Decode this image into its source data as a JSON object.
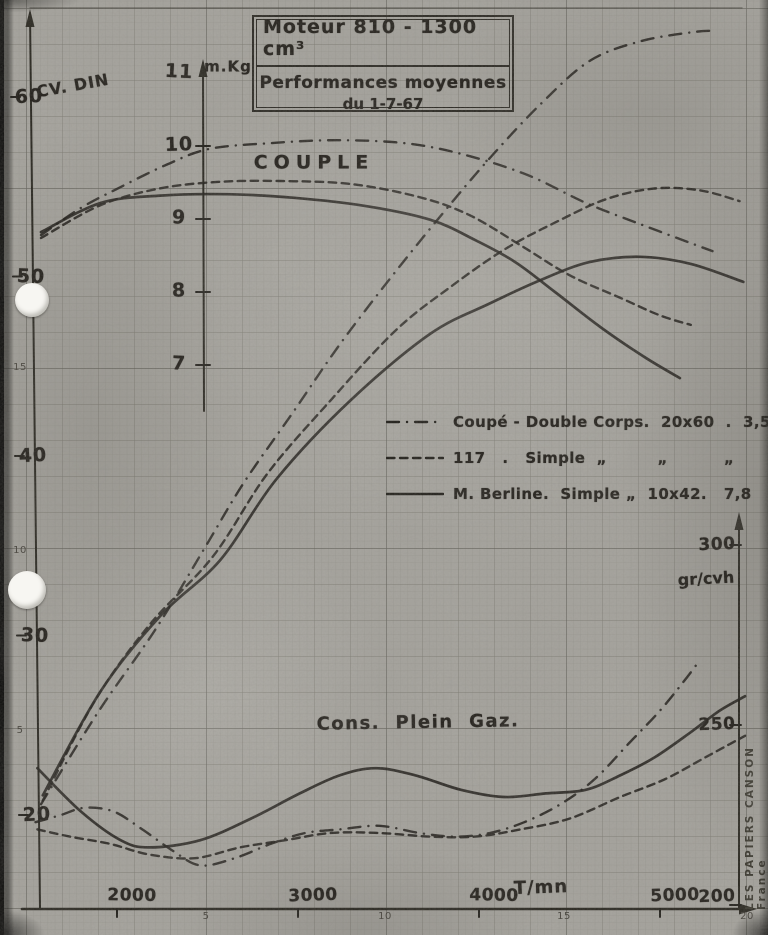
{
  "document": {
    "title_line1": "Moteur 810  - 1300 cm³",
    "title_line2": "Performances moyennes",
    "title_line3": "du 1-7-67",
    "brand_vertical_text": "LES PAPIERS CANSON  France"
  },
  "annotations": {
    "torque_label": "COUPLE",
    "consumption_label": "Cons.  Plein  Gaz.",
    "power_axis_title": "CV. DIN",
    "torque_axis_title": "m.Kg",
    "consumption_axis_title": "gr/cvh",
    "rpm_axis_title": "T/mn"
  },
  "legend": {
    "rows": [
      {
        "style": "dashdot",
        "label": "Coupé - Double Corps.  20x60  .  3,5"
      },
      {
        "style": "dashed",
        "label": "117   .   Simple  „         „          „"
      },
      {
        "style": "solid",
        "label": "M. Berline.  Simple „  10x42.   7,8"
      }
    ]
  },
  "colors": {
    "paper": "#a8a6a0",
    "ink": "#1f1d18",
    "grid": "#6e6c62"
  },
  "chart_data": {
    "type": "line",
    "title": "Moteur 810 - 1300 cm³ — Performances moyennes du 1-7-67",
    "grid": true,
    "legend_position": "middle-right",
    "x_axis": {
      "label": "T/mn",
      "ticks": [
        2000,
        3000,
        4000,
        5000
      ],
      "range": [
        1550,
        5550
      ]
    },
    "y_axes": {
      "power_cv_din": {
        "label": "CV. DIN",
        "ticks": [
          60,
          50,
          40,
          30,
          20
        ],
        "range": [
          15,
          65
        ]
      },
      "torque_mkg": {
        "label": "m.Kg",
        "ticks": [
          11,
          10,
          9,
          8,
          7
        ],
        "range": [
          6.5,
          11.5
        ]
      },
      "consumption_gr_cvh": {
        "label": "gr/cvh",
        "ticks": [
          300,
          250,
          200
        ],
        "range": [
          195,
          310
        ]
      }
    },
    "paper_scale_numbers": {
      "bottom": [
        "5",
        "10",
        "15",
        "20"
      ],
      "left": [
        "15",
        "10",
        "5"
      ]
    },
    "series": [
      {
        "id": "power-coupe",
        "name": "Coupé Double Corps — puissance (CV DIN)",
        "style": "dashdot",
        "unit": "cv",
        "points": [
          [
            1580,
            20.6
          ],
          [
            1900,
            25.8
          ],
          [
            2210,
            30.3
          ],
          [
            2480,
            34.8
          ],
          [
            2700,
            38.5
          ],
          [
            2970,
            42.4
          ],
          [
            3230,
            46.2
          ],
          [
            3510,
            49.9
          ],
          [
            3790,
            53.4
          ],
          [
            4060,
            56.6
          ],
          [
            4340,
            59.6
          ],
          [
            4610,
            62.0
          ],
          [
            4890,
            63.1
          ],
          [
            5170,
            63.6
          ],
          [
            5310,
            63.7
          ]
        ]
      },
      {
        "id": "power-117",
        "name": "117 Simple — puissance (CV DIN)",
        "style": "dashed",
        "unit": "cv",
        "points": [
          [
            1590,
            20.8
          ],
          [
            1880,
            26.4
          ],
          [
            2180,
            30.6
          ],
          [
            2530,
            34.4
          ],
          [
            2830,
            39.0
          ],
          [
            3180,
            43.1
          ],
          [
            3540,
            47.0
          ],
          [
            3840,
            49.4
          ],
          [
            4140,
            51.5
          ],
          [
            4420,
            53.0
          ],
          [
            4700,
            54.3
          ],
          [
            4970,
            54.9
          ],
          [
            5220,
            54.8
          ],
          [
            5440,
            54.2
          ]
        ]
      },
      {
        "id": "power-berline",
        "name": "M. Berline Simple — puissance (CV DIN)",
        "style": "solid",
        "unit": "cv",
        "points": [
          [
            1590,
            21.1
          ],
          [
            1910,
            26.9
          ],
          [
            2240,
            31.1
          ],
          [
            2570,
            34.2
          ],
          [
            2880,
            38.7
          ],
          [
            3290,
            43.1
          ],
          [
            3730,
            46.8
          ],
          [
            4060,
            48.5
          ],
          [
            4340,
            49.8
          ],
          [
            4610,
            50.8
          ],
          [
            4890,
            51.1
          ],
          [
            5170,
            50.7
          ],
          [
            5460,
            49.7
          ]
        ]
      },
      {
        "id": "torque-coupe",
        "name": "Coupé Double Corps — couple (m.Kg)",
        "style": "dashdot",
        "unit": "mkg",
        "points": [
          [
            1580,
            8.78
          ],
          [
            1800,
            9.15
          ],
          [
            1990,
            9.4
          ],
          [
            2270,
            9.74
          ],
          [
            2510,
            9.96
          ],
          [
            2850,
            10.04
          ],
          [
            3230,
            10.08
          ],
          [
            3620,
            10.03
          ],
          [
            3950,
            9.86
          ],
          [
            4280,
            9.59
          ],
          [
            4590,
            9.22
          ],
          [
            4890,
            8.93
          ],
          [
            5170,
            8.67
          ],
          [
            5290,
            8.56
          ]
        ]
      },
      {
        "id": "torque-117",
        "name": "117 Simple — couple (m.Kg)",
        "style": "dashed",
        "unit": "mkg",
        "points": [
          [
            1580,
            8.74
          ],
          [
            1910,
            9.19
          ],
          [
            2240,
            9.42
          ],
          [
            2570,
            9.51
          ],
          [
            2900,
            9.52
          ],
          [
            3290,
            9.48
          ],
          [
            3670,
            9.3
          ],
          [
            3950,
            9.05
          ],
          [
            4230,
            8.64
          ],
          [
            4500,
            8.23
          ],
          [
            4780,
            7.92
          ],
          [
            5000,
            7.68
          ],
          [
            5170,
            7.55
          ]
        ]
      },
      {
        "id": "torque-berline",
        "name": "M. Berline Simple — couple (m.Kg)",
        "style": "solid",
        "unit": "mkg",
        "points": [
          [
            1580,
            8.82
          ],
          [
            1910,
            9.22
          ],
          [
            2240,
            9.32
          ],
          [
            2600,
            9.34
          ],
          [
            2980,
            9.29
          ],
          [
            3370,
            9.18
          ],
          [
            3730,
            8.99
          ],
          [
            3980,
            8.71
          ],
          [
            4200,
            8.41
          ],
          [
            4420,
            8.0
          ],
          [
            4670,
            7.52
          ],
          [
            4920,
            7.1
          ],
          [
            5110,
            6.82
          ]
        ]
      },
      {
        "id": "cons-coupe",
        "name": "Coupé Double Corps — consommation pleine charge (gr/cvh)",
        "style": "dashdot",
        "unit": "gr",
        "points": [
          [
            1550,
            223
          ],
          [
            1690,
            225
          ],
          [
            1820,
            227
          ],
          [
            1980,
            226
          ],
          [
            2140,
            221
          ],
          [
            2310,
            215
          ],
          [
            2460,
            211
          ],
          [
            2650,
            213
          ],
          [
            2850,
            217
          ],
          [
            3040,
            220
          ],
          [
            3230,
            221
          ],
          [
            3450,
            222
          ],
          [
            3670,
            220
          ],
          [
            3870,
            219
          ],
          [
            4060,
            220
          ],
          [
            4250,
            223
          ],
          [
            4450,
            228
          ],
          [
            4640,
            235
          ],
          [
            4830,
            245
          ],
          [
            5000,
            254
          ],
          [
            5130,
            262
          ],
          [
            5220,
            268
          ]
        ]
      },
      {
        "id": "cons-117",
        "name": "117 Simple — consommation pleine charge (gr/cvh)",
        "style": "dashed",
        "unit": "gr",
        "points": [
          [
            1560,
            221
          ],
          [
            1740,
            219
          ],
          [
            1960,
            217
          ],
          [
            2180,
            214
          ],
          [
            2430,
            213
          ],
          [
            2680,
            216
          ],
          [
            2930,
            218
          ],
          [
            3180,
            220
          ],
          [
            3450,
            220
          ],
          [
            3730,
            219
          ],
          [
            3980,
            219
          ],
          [
            4230,
            221
          ],
          [
            4500,
            224
          ],
          [
            4780,
            230
          ],
          [
            5030,
            235
          ],
          [
            5250,
            241
          ],
          [
            5470,
            247
          ]
        ]
      },
      {
        "id": "cons-berline",
        "name": "M. Berline Simple — consommation pleine charge (gr/cvh)",
        "style": "solid",
        "unit": "gr",
        "points": [
          [
            1560,
            238
          ],
          [
            1800,
            226
          ],
          [
            2020,
            218
          ],
          [
            2180,
            216
          ],
          [
            2460,
            218
          ],
          [
            2740,
            224
          ],
          [
            3010,
            231
          ],
          [
            3230,
            236
          ],
          [
            3430,
            238
          ],
          [
            3650,
            236
          ],
          [
            3900,
            232
          ],
          [
            4140,
            230
          ],
          [
            4370,
            231
          ],
          [
            4590,
            232
          ],
          [
            4780,
            236
          ],
          [
            4970,
            241
          ],
          [
            5170,
            248
          ],
          [
            5330,
            254
          ],
          [
            5470,
            258
          ]
        ]
      }
    ]
  }
}
